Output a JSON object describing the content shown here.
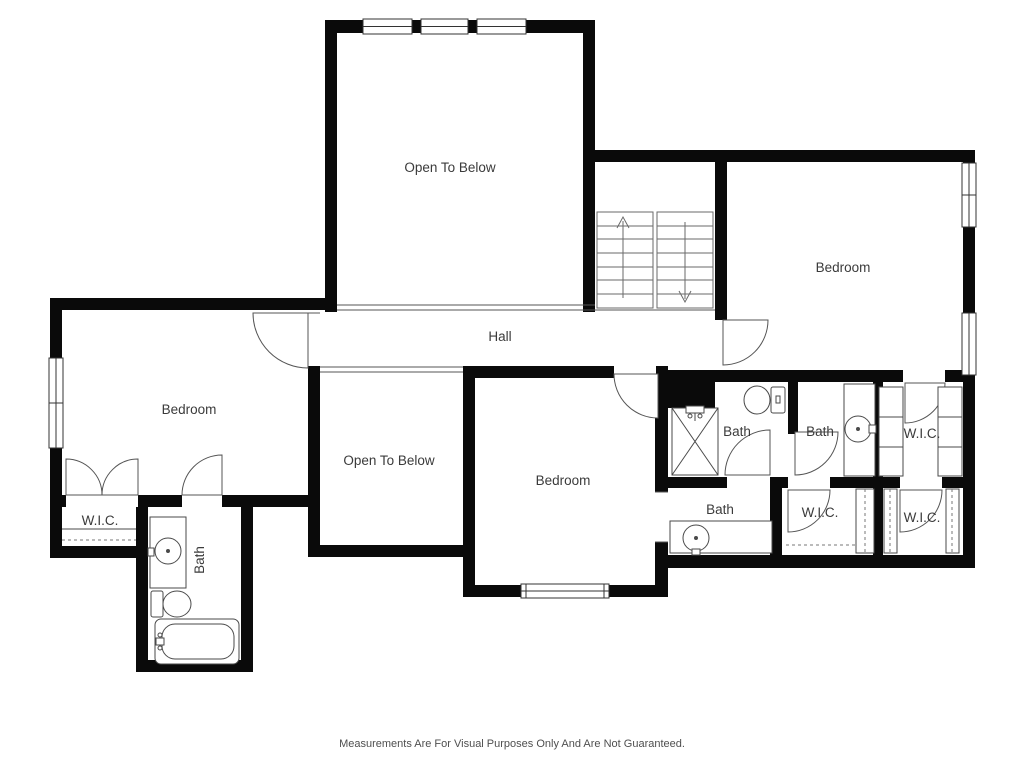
{
  "plan": {
    "type": "floor-plan",
    "floor": "second-floor",
    "colors": {
      "wall": "#0a0a0a",
      "fixture_line": "#4a4a4a",
      "stair_line": "#6a6a6a",
      "label": "#3b3b3b",
      "background": "#ffffff"
    },
    "rooms": {
      "open_to_below_top": "Open To Below",
      "bedroom_right": "Bedroom",
      "hall": "Hall",
      "bedroom_left": "Bedroom",
      "open_to_below_center": "Open To Below",
      "bedroom_center": "Bedroom",
      "bath_1": "Bath",
      "bath_2": "Bath",
      "wic_1": "W.I.C.",
      "bath_3": "Bath",
      "wic_2": "W.I.C.",
      "wic_3": "W.I.C.",
      "wic_left": "W.I.C.",
      "bath_left": "Bath"
    },
    "footer": {
      "disclaimer": "Measurements Are For Visual Purposes Only And Are Not Guaranteed."
    }
  }
}
